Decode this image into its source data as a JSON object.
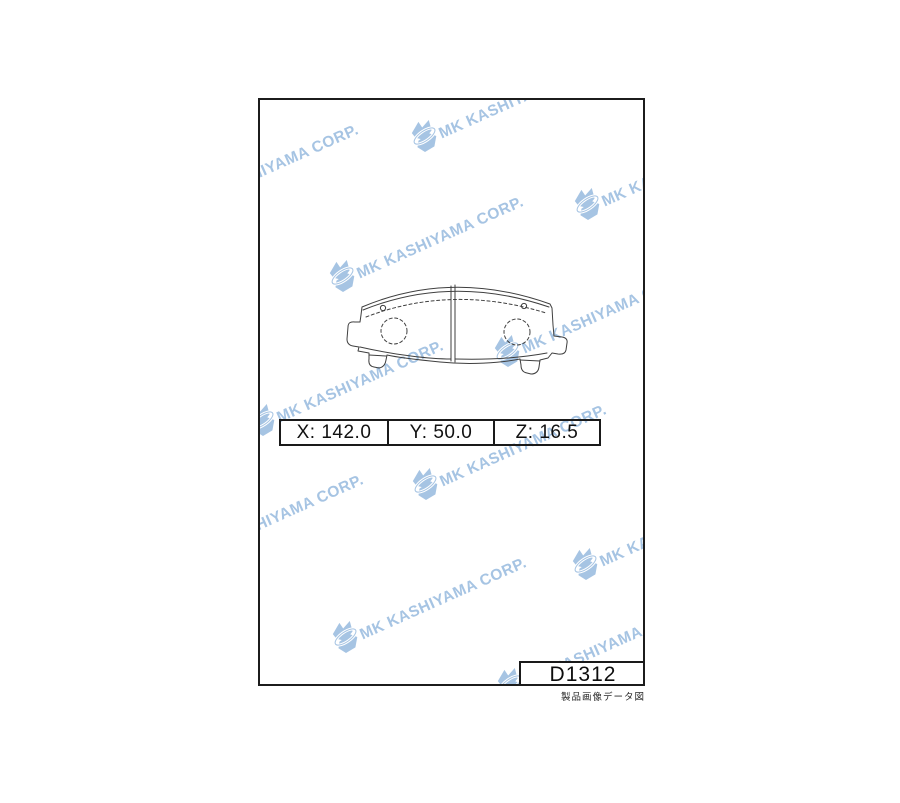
{
  "page": {
    "background": "#ffffff"
  },
  "watermark": {
    "text": "MK KASHIYAMA CORP.",
    "color": "#a6c4e3",
    "icon": "butterfly-logo-icon"
  },
  "drawing": {
    "name": "brake-pad-front-view",
    "line_color": "#3f3f3f"
  },
  "dimensions": {
    "cells": [
      "X: 142.0",
      "Y: 50.0",
      "Z: 16.5"
    ]
  },
  "part_number": "D1312",
  "caption": "製品画像データ図"
}
